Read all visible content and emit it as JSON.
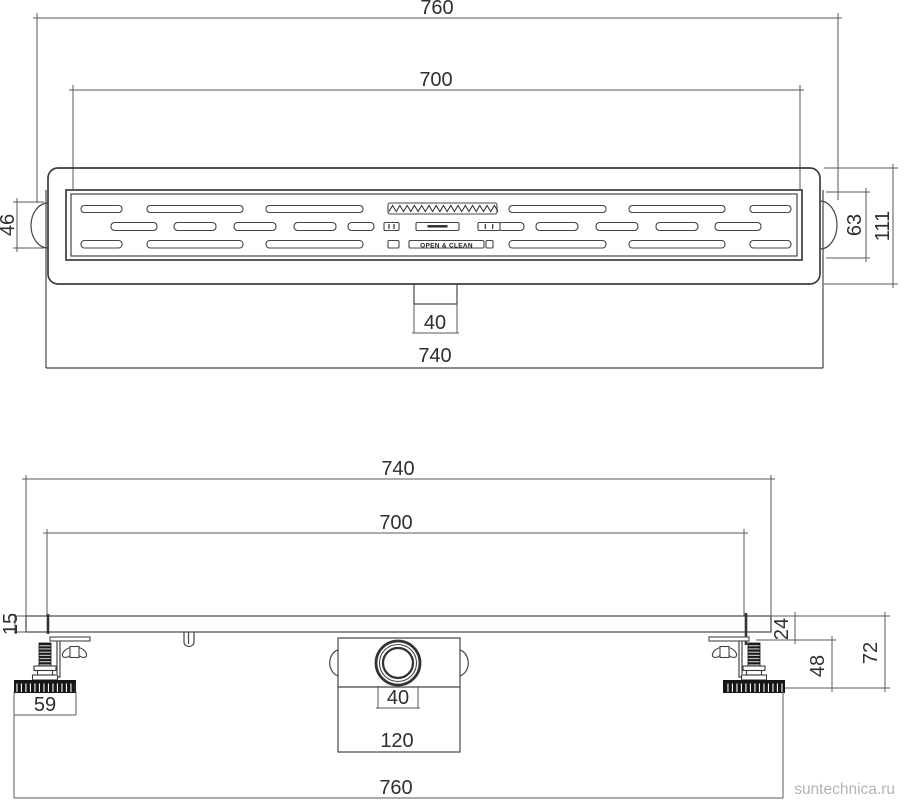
{
  "watermark": {
    "label": "suntechnica.ru",
    "color": "#b3b3b3"
  },
  "colors": {
    "line": "#454545",
    "text": "#2f2f2f",
    "dark_fill": "#161616"
  },
  "top_view": {
    "dims": {
      "overall_width": "760",
      "grate_length": "700",
      "flange_width": "740",
      "outlet_width": "40",
      "left_socket_height": "46",
      "right_socket_height": "63",
      "body_height": "111"
    },
    "grate": {
      "center_label": "OPEN & CLEAN",
      "rows": {
        "row1": {
          "y": 205.5,
          "h": 7,
          "slots": [
            [
              81,
              41
            ],
            [
              147,
              96
            ],
            [
              266,
              97
            ],
            [
              509,
              97
            ],
            [
              629,
              96
            ],
            [
              750,
              41
            ]
          ]
        },
        "row2": {
          "y": 222.5,
          "h": 8,
          "slots": [
            [
              111,
              46
            ],
            [
              174,
              42
            ],
            [
              234,
              42
            ],
            [
              294,
              42
            ],
            [
              348,
              26
            ],
            [
              498,
              26
            ],
            [
              536,
              42
            ],
            [
              596,
              42
            ],
            [
              656,
              42
            ],
            [
              715,
              46
            ]
          ],
          "center_boxes": [
            [
              384,
              15
            ],
            [
              416,
              43
            ],
            [
              478,
              22
            ]
          ]
        },
        "row3": {
          "y": 240.5,
          "h": 7.5,
          "slots": [
            [
              81,
              41
            ],
            [
              147,
              96
            ],
            [
              266,
              97
            ],
            [
              509,
              97
            ],
            [
              629,
              96
            ],
            [
              750,
              41
            ]
          ],
          "center_boxes": [
            [
              388,
              11
            ],
            [
              486,
              7
            ]
          ],
          "text_slot": [
            409,
            75
          ]
        }
      },
      "zigzag": {
        "x": 388,
        "y": 203,
        "w": 109,
        "h": 11,
        "periods": 15
      }
    }
  },
  "side_view": {
    "dims": {
      "flange_width": "740",
      "channel_length": "700",
      "plate_thickness": "15",
      "rim_height": "24",
      "foot_zone_height": "48",
      "total_height": "72",
      "foot_width": "59",
      "outlet_diameter": "40",
      "trap_width": "120",
      "overall_width": "760"
    },
    "feet": {
      "left_cx": 45,
      "right_cx": 754
    }
  }
}
